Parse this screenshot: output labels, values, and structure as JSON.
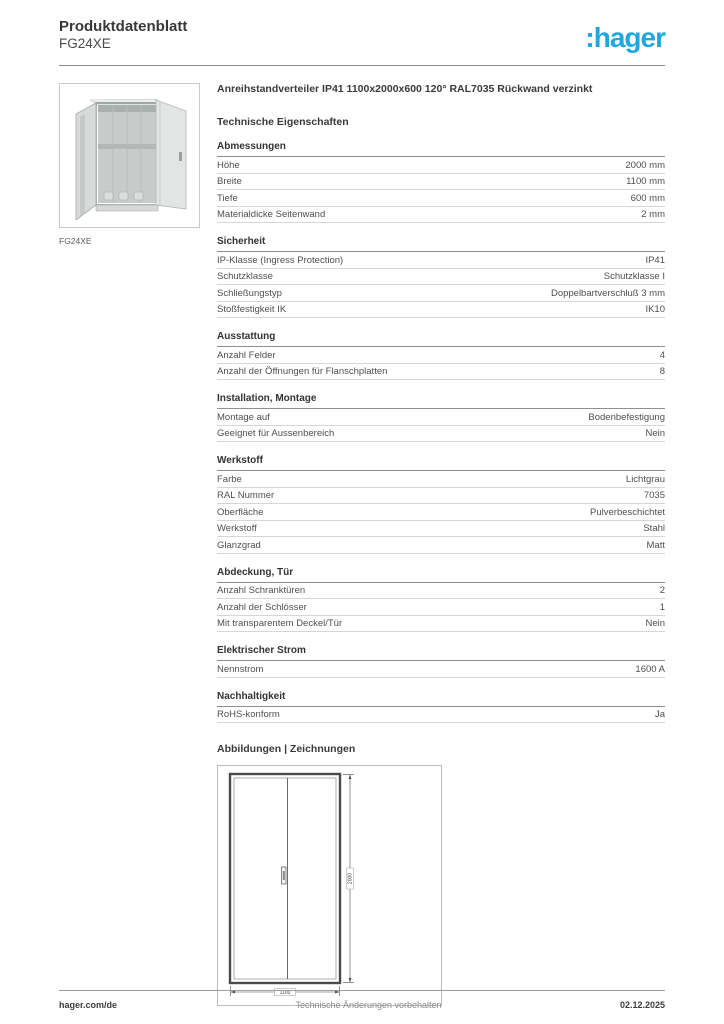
{
  "page": {
    "title": "Produktdatenblatt",
    "reference": "FG24XE",
    "logo_text": ":hager",
    "brand_color": "#1FA8E0"
  },
  "product": {
    "title": "Anreihstandverteiler IP41 1100x2000x600 120° RAL7035 Rückwand verzinkt",
    "image_caption": "FG24XE"
  },
  "tech_heading": "Technische Eigenschaften",
  "sections": [
    {
      "title": "Abmessungen",
      "rows": [
        {
          "label": "Höhe",
          "value": "2000 mm"
        },
        {
          "label": "Breite",
          "value": "1100 mm"
        },
        {
          "label": "Tiefe",
          "value": "600 mm"
        },
        {
          "label": "Materialdicke Seitenwand",
          "value": "2 mm"
        }
      ]
    },
    {
      "title": "Sicherheit",
      "rows": [
        {
          "label": "IP-Klasse (Ingress Protection)",
          "value": "IP41"
        },
        {
          "label": "Schutzklasse",
          "value": "Schutzklasse I"
        },
        {
          "label": "Schließungstyp",
          "value": "Doppelbartverschluß 3 mm"
        },
        {
          "label": "Stoßfestigkeit IK",
          "value": "IK10"
        }
      ]
    },
    {
      "title": "Ausstattung",
      "rows": [
        {
          "label": "Anzahl Felder",
          "value": "4"
        },
        {
          "label": "Anzahl der Öffnungen für Flanschplatten",
          "value": "8"
        }
      ]
    },
    {
      "title": "Installation, Montage",
      "rows": [
        {
          "label": "Montage auf",
          "value": "Bodenbefestigung"
        },
        {
          "label": "Geeignet für Aussenbereich",
          "value": "Nein"
        }
      ]
    },
    {
      "title": "Werkstoff",
      "rows": [
        {
          "label": "Farbe",
          "value": "Lichtgrau"
        },
        {
          "label": "RAL Nummer",
          "value": "7035"
        },
        {
          "label": "Oberfläche",
          "value": "Pulverbeschichtet"
        },
        {
          "label": "Werkstoff",
          "value": "Stahl"
        },
        {
          "label": "Glanzgrad",
          "value": "Matt"
        }
      ]
    },
    {
      "title": "Abdeckung, Tür",
      "rows": [
        {
          "label": "Anzahl Schranktüren",
          "value": "2"
        },
        {
          "label": "Anzahl der Schlösser",
          "value": "1"
        },
        {
          "label": "Mit transparentem Deckel/Tür",
          "value": "Nein"
        }
      ]
    },
    {
      "title": "Elektrischer Strom",
      "rows": [
        {
          "label": "Nennstrom",
          "value": "1600 A"
        }
      ]
    },
    {
      "title": "Nachhaltigkeit",
      "rows": [
        {
          "label": "RoHS-konform",
          "value": "Ja"
        }
      ]
    }
  ],
  "drawings_heading": "Abbildungen | Zeichnungen",
  "drawing": {
    "height_label": "2000",
    "width_label": "1100"
  },
  "footer": {
    "site": "hager.com/de",
    "notice": "Technische Änderungen vorbehalten",
    "date": "02.12.2025"
  }
}
